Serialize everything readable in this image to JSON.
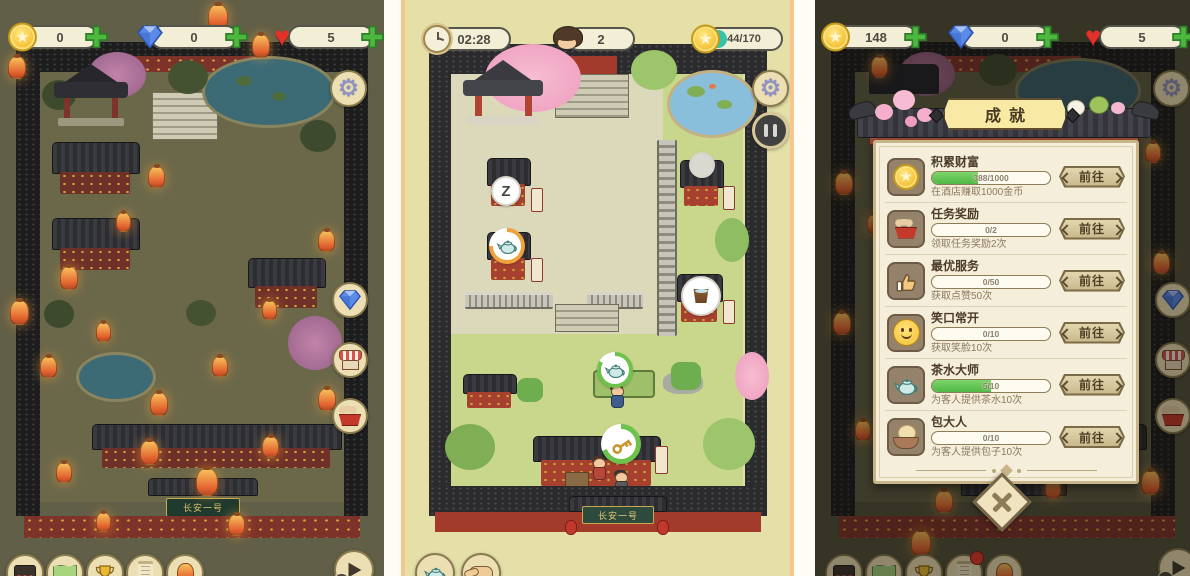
{
  "left_screen": {
    "resources": {
      "coins": "0",
      "diamonds": "0",
      "hearts": "5"
    },
    "gate_sign": "长安一号",
    "play_badge": "1",
    "side_icons": [
      "gear-icon",
      "diamond-icon",
      "shop-icon",
      "gift-icon"
    ],
    "toolbar_icons": [
      "inn-icon",
      "map-icon",
      "trophy-icon",
      "scroll-icon",
      "lantern-icon",
      "play-icon"
    ]
  },
  "middle_screen": {
    "timer": "02:28",
    "guest_count": "2",
    "coin_goal": "44/170",
    "coin_goal_pct": 26,
    "sleep_marker": "Z",
    "gate_sign": "长安一号",
    "action_icons": [
      "teapot-icon",
      "hand-icon"
    ]
  },
  "right_screen": {
    "resources": {
      "coins": "148",
      "diamonds": "0",
      "hearts": "5"
    },
    "play_badge": "4",
    "dialog": {
      "title": "成就",
      "go_label": "前往",
      "achievements": [
        {
          "name": "积累财富",
          "desc": "在酒店赚取1000金币",
          "progress": "388/1000",
          "pct": 39,
          "icon": "coin-icon"
        },
        {
          "name": "任务奖励",
          "desc": "领取任务奖励2次",
          "progress": "0/2",
          "pct": 0,
          "icon": "gift-box-icon"
        },
        {
          "name": "最优服务",
          "desc": "获取点赞50次",
          "progress": "0/50",
          "pct": 0,
          "icon": "thumbs-up-icon"
        },
        {
          "name": "笑口常开",
          "desc": "获取笑脸10次",
          "progress": "0/10",
          "pct": 0,
          "icon": "smiley-icon"
        },
        {
          "name": "茶水大师",
          "desc": "为客人提供茶水10次",
          "progress": "5/10",
          "pct": 50,
          "icon": "teapot-icon"
        },
        {
          "name": "包大人",
          "desc": "为客人提供包子10次",
          "progress": "0/10",
          "pct": 0,
          "icon": "bun-icon"
        }
      ]
    }
  },
  "colors": {
    "accent_green": "#4db83e",
    "progress_green": "#4eb845",
    "progress_teal": "#35c3ab",
    "parchment": "#f5eeda",
    "gold_coin": "#f3bd2e"
  }
}
